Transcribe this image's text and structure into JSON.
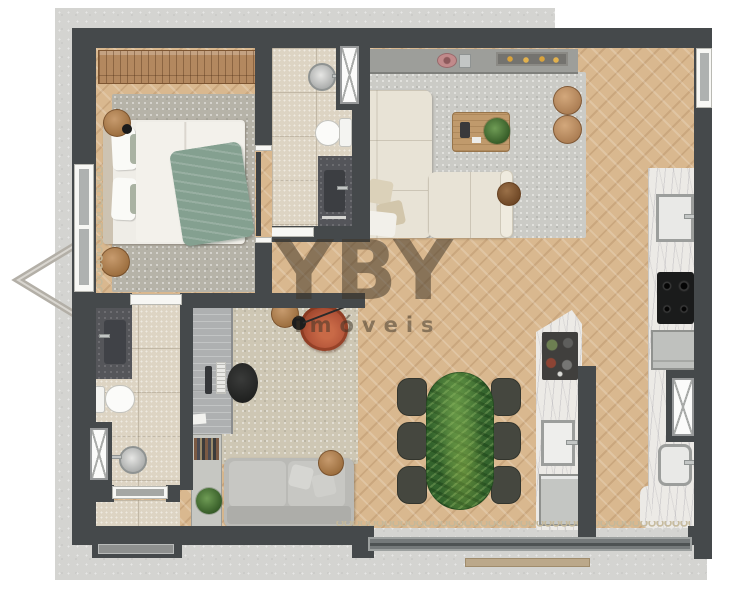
{
  "watermark": {
    "brand": "YBY",
    "tagline": "imóveis"
  },
  "palette": {
    "wall": "#45494b",
    "concrete": "#d4d4d1",
    "wood_floor": "#d9b88f",
    "tile_floor": "#ddd4c3",
    "marble_counter": "#eceae6",
    "green_marble_table": "#386c2e",
    "terracotta_chair": "#b5563a",
    "cream_sofa": "#e8e3d6",
    "gray_rug": "#cbcbc6",
    "watermark_color": "rgba(62,51,39,0.52)"
  },
  "icons": {
    "entrance_arrow": "chevron-left"
  },
  "rooms": [
    {
      "name": "bedroom",
      "fixtures": [
        "wardrobe",
        "double-bed",
        "pillows",
        "green-throw",
        "area-rug",
        "round-stools",
        "window",
        "curtain"
      ]
    },
    {
      "name": "ensuite-bathroom",
      "fixtures": [
        "round-sink",
        "toilet",
        "stone-vanity",
        "ventilation-shaft",
        "door"
      ]
    },
    {
      "name": "living-room",
      "fixtures": [
        "tv-console",
        "decor-tray",
        "l-shaped-sofa",
        "coffee-table",
        "monstera-plant",
        "poufs",
        "side-table",
        "area-rug"
      ]
    },
    {
      "name": "kitchen",
      "fixtures": [
        "wall-counter",
        "square-sink",
        "cooktop",
        "oven",
        "island",
        "island-sink",
        "dishwasher",
        "bar-tray",
        "ventilation-shaft"
      ]
    },
    {
      "name": "dining-area",
      "fixtures": [
        "green-marble-table",
        "six-chairs"
      ]
    },
    {
      "name": "office",
      "fixtures": [
        "desk",
        "monitor",
        "keyboard",
        "office-chair",
        "bookshelf",
        "plant",
        "lounge-chair",
        "floor-lamp",
        "loveseat",
        "side-table",
        "area-rug"
      ]
    },
    {
      "name": "guest-bathroom",
      "fixtures": [
        "stone-shower",
        "toilet",
        "round-sink",
        "ventilation-shaft"
      ]
    },
    {
      "name": "entry",
      "fixtures": [
        "entrance-door",
        "doormat"
      ]
    },
    {
      "name": "balcony",
      "fixtures": [
        "sliding-glass-door",
        "railing",
        "deck-plank"
      ]
    }
  ]
}
